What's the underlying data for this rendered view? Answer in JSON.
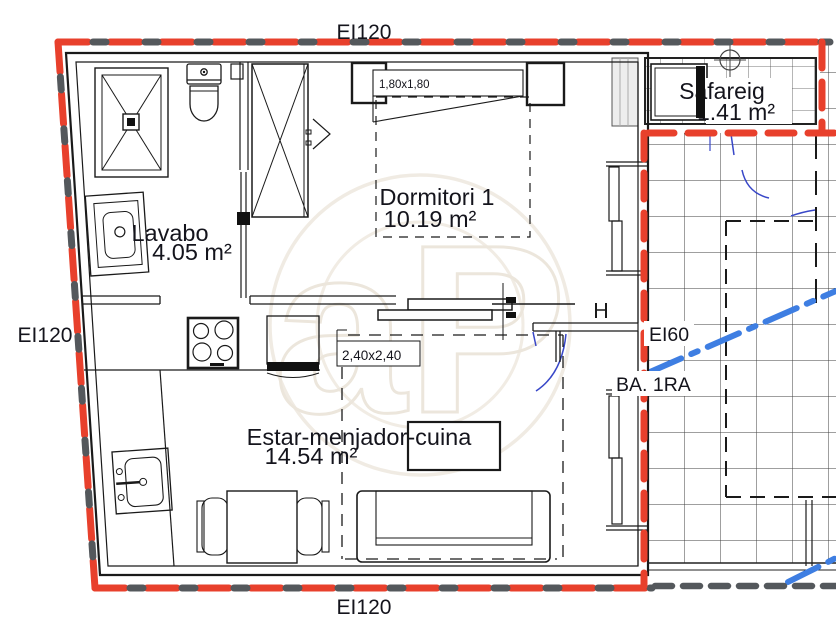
{
  "plan": {
    "fire_rating_labels": {
      "top": "EI120",
      "left": "EI120",
      "bottom": "EI120",
      "inner": "EI60"
    },
    "axis_label": "BA. 1RA",
    "rooms": {
      "safareig": {
        "name": "Safareig",
        "area": "1.41 m²"
      },
      "dormitori": {
        "name": "Dormitori 1",
        "area": "10.19 m²"
      },
      "lavabo": {
        "name": "Lavabo",
        "area": "4.05 m²"
      },
      "estar": {
        "name": "Estar-menjador-cuina",
        "area": "14.54 m²"
      }
    },
    "dimension_labels": {
      "bed": "1,80x1,80",
      "living_zone": "2,40x2,40"
    },
    "watermark": "aP",
    "colors": {
      "fire_line_red": "#e8402c",
      "fire_line_gray": "#54585c",
      "utility_line_blue": "#3e7ee2",
      "door_swing_blue": "#3847c8",
      "wall_black": "#1a1a1a"
    }
  }
}
